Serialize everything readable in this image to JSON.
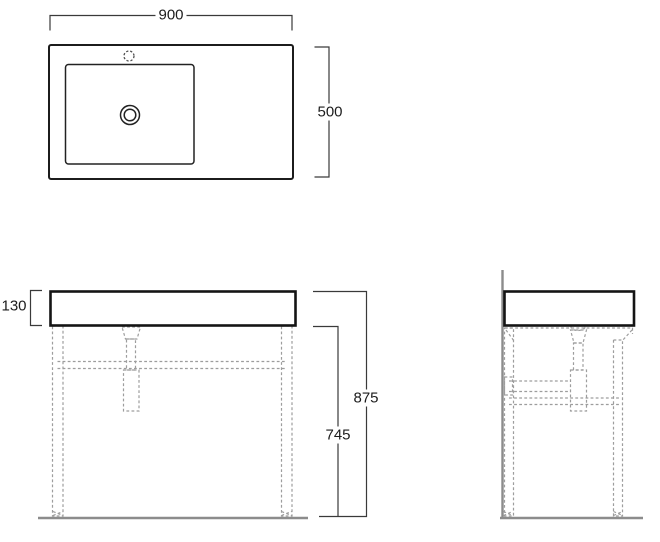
{
  "diagram": {
    "dimensions": {
      "width": "900",
      "depth": "500",
      "basin_height": "130",
      "total_height": "875",
      "stand_height": "745"
    },
    "colors": {
      "outline": "#141414",
      "dashed_hidden_lines": "#9d9d9d",
      "ground_and_wall": "#8c8c8c",
      "dimension_lines": "#3a3a3a",
      "text": "#1c1c1c",
      "background": "#ffffff"
    }
  }
}
